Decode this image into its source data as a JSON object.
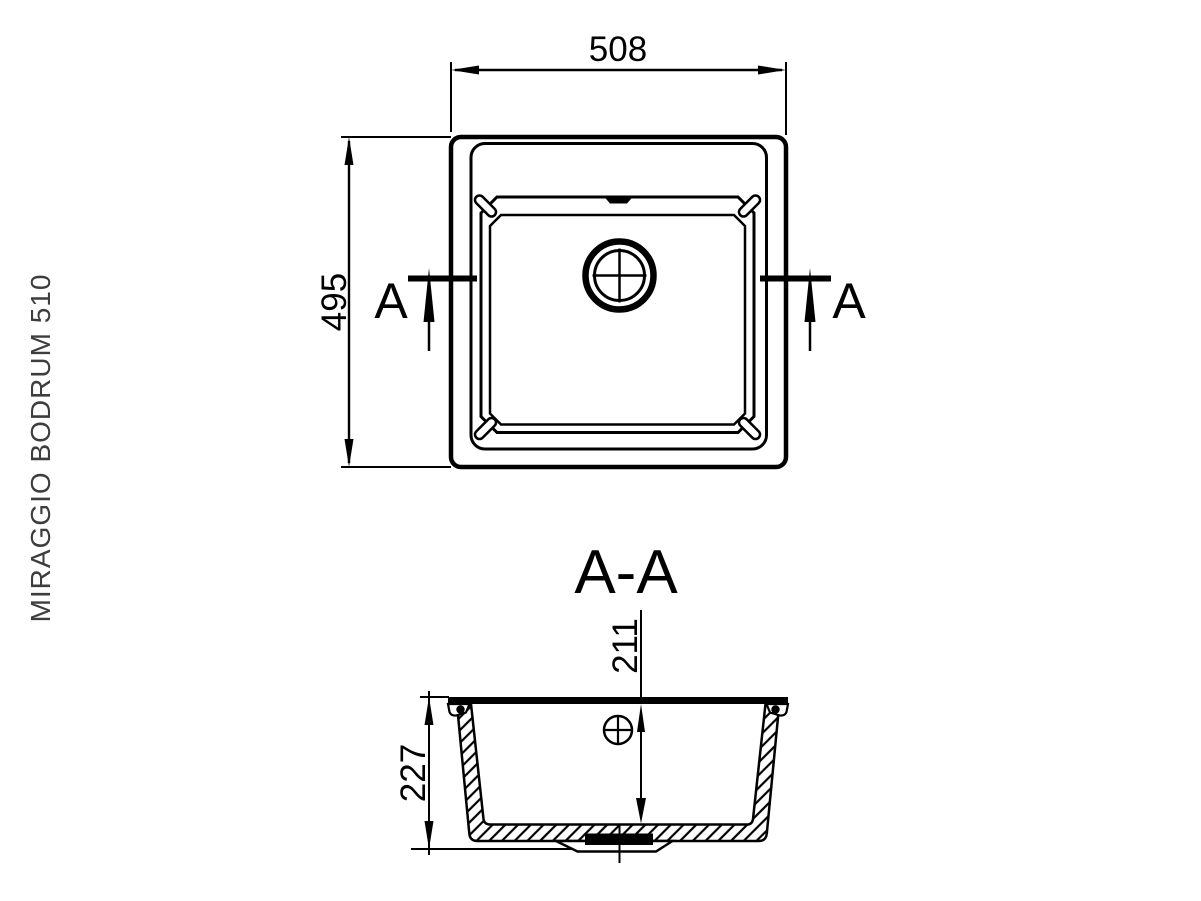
{
  "colors": {
    "line": "#000000",
    "label": "#3d3d3d",
    "background": "#ffffff"
  },
  "side_label": {
    "text": "MIRAGGIO BODRUM 510"
  },
  "top_view": {
    "width_dim": "508",
    "height_dim": "495",
    "cut_letter_left": "A",
    "cut_letter_right": "A"
  },
  "section_view": {
    "title": "A-A",
    "drain_depth_dim": "211",
    "overall_depth_dim": "227"
  }
}
